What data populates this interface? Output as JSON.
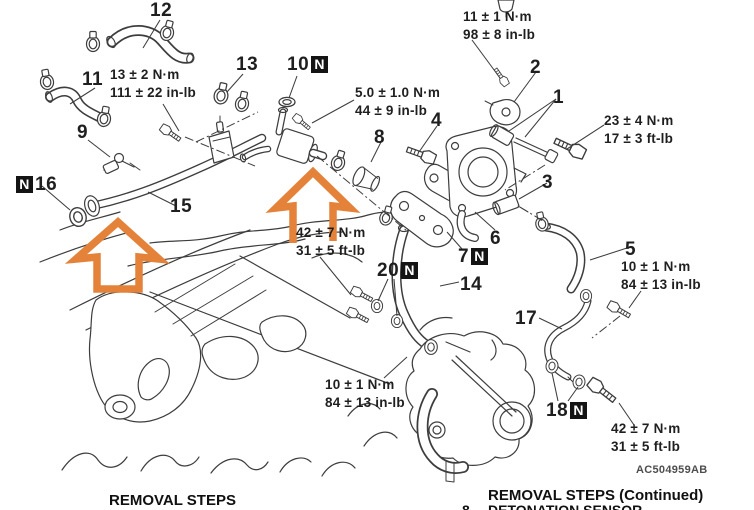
{
  "figure": {
    "code": "AC504959AB",
    "badge_letter": "N"
  },
  "callouts": {
    "p1": "1",
    "p2": "2",
    "p3": "3",
    "p4": "4",
    "p5": "5",
    "p6": "6",
    "p7": "7",
    "p8": "8",
    "p9": "9",
    "p10": "10",
    "p11": "11",
    "p12": "12",
    "p13": "13",
    "p14": "14",
    "p15": "15",
    "p16": "16",
    "p17": "17",
    "p18": "18",
    "p20": "20"
  },
  "torques": {
    "hose_clamp": {
      "line1": "13 ± 2 N·m",
      "line2": "111 ± 22 in-lb"
    },
    "water_fitting": {
      "line1": "5.0 ± 1.0 N·m",
      "line2": "44 ± 9 in-lb"
    },
    "sensor_bracket": {
      "line1": "11 ± 1 N·m",
      "line2": "98 ± 8 in-lb"
    },
    "throttle_bolt": {
      "line1": "23 ± 4 N·m",
      "line2": "17 ± 3 ft-lb"
    },
    "center_bolts": {
      "line1": "42 ± 7 N·m",
      "line2": "31 ± 5 ft-lb"
    },
    "right_fitting": {
      "line1": "10 ± 1 N·m",
      "line2": "84 ± 13 in-lb"
    },
    "lower_bolts": {
      "line1": "10 ± 1 N·m",
      "line2": "84 ± 13 in-lb"
    },
    "rear_bolt": {
      "line1": "42 ± 7 N·m",
      "line2": "31 ± 5 ft-lb"
    }
  },
  "footer": {
    "left_title": "REMOVAL STEPS",
    "right_title": "REMOVAL STEPS (Continued)",
    "continued_item_number": "8",
    "continued_item_label": "DETONATION SENSOR"
  },
  "colors": {
    "line": "#3d3d3d",
    "arrow_orange": "#e5823a",
    "badge_bg": "#141414",
    "ink": "#1f1f1f"
  }
}
